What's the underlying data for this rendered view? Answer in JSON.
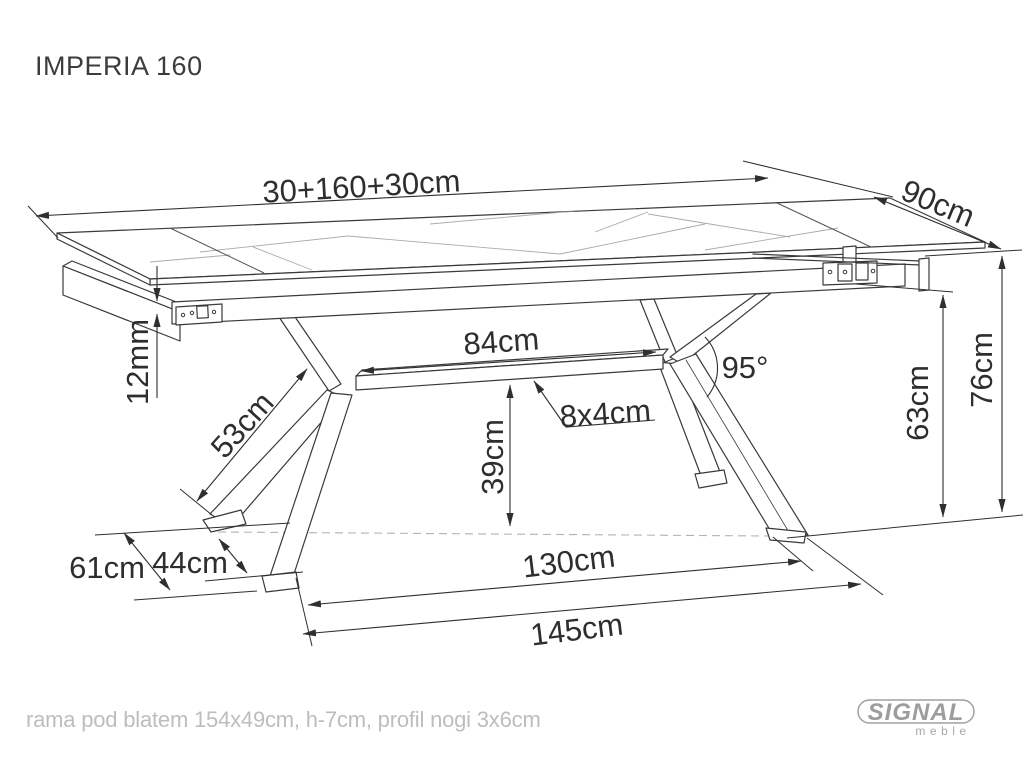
{
  "title": "IMPERIA 160",
  "dimensions": {
    "total_length": "30+160+30cm",
    "depth": "90cm",
    "beam_length": "84cm",
    "leg_angle": "95°",
    "beam_profile": "8x4cm",
    "top_thickness": "12mm",
    "leg_length": "53cm",
    "beam_clearance": "39cm",
    "feet_gap_depth": "44cm",
    "base_depth": "61cm",
    "feet_span": "130cm",
    "base_length": "145cm",
    "clearance_height": "63cm",
    "total_height": "76cm"
  },
  "footer": {
    "note": "rama pod blatem 154x49cm, h-7cm, profil nogi 3x6cm"
  },
  "logo": {
    "brand": "SIGNAL",
    "sub": "meble"
  },
  "colors": {
    "line": "#3a3a3a",
    "dim_text": "#2e2e2e",
    "muted_text": "#bdbdbd",
    "logo_gray": "#9d9d9d",
    "background": "#ffffff"
  }
}
